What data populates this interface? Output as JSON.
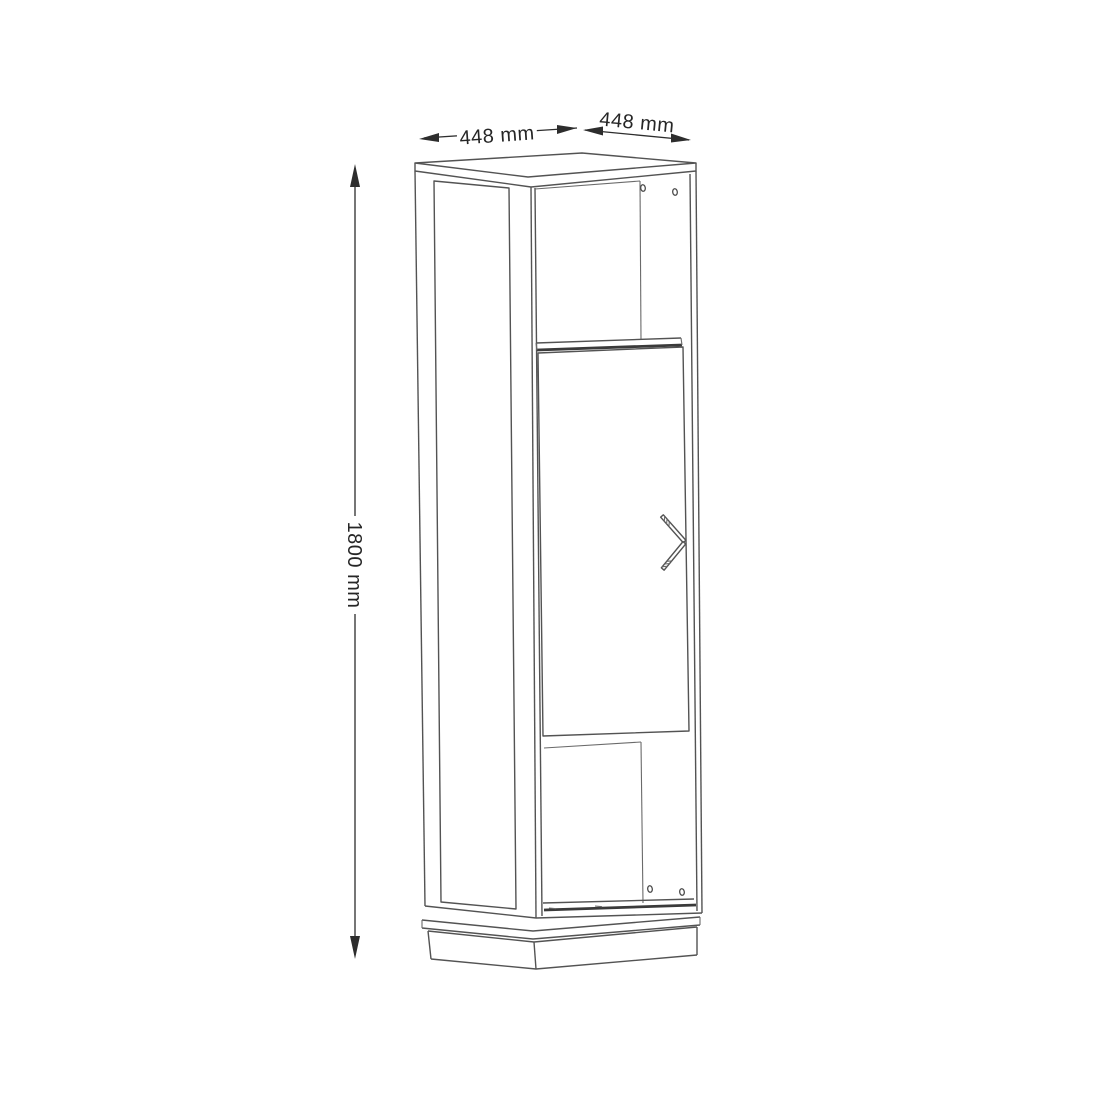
{
  "drawing": {
    "subject": "tall-cabinet-technical-drawing",
    "dimensions": {
      "width": "448 mm",
      "depth": "448 mm",
      "height": "1800 mm"
    },
    "colors": {
      "background": "#ffffff",
      "line": "#535353",
      "dimension": "#2d2d2d"
    }
  }
}
